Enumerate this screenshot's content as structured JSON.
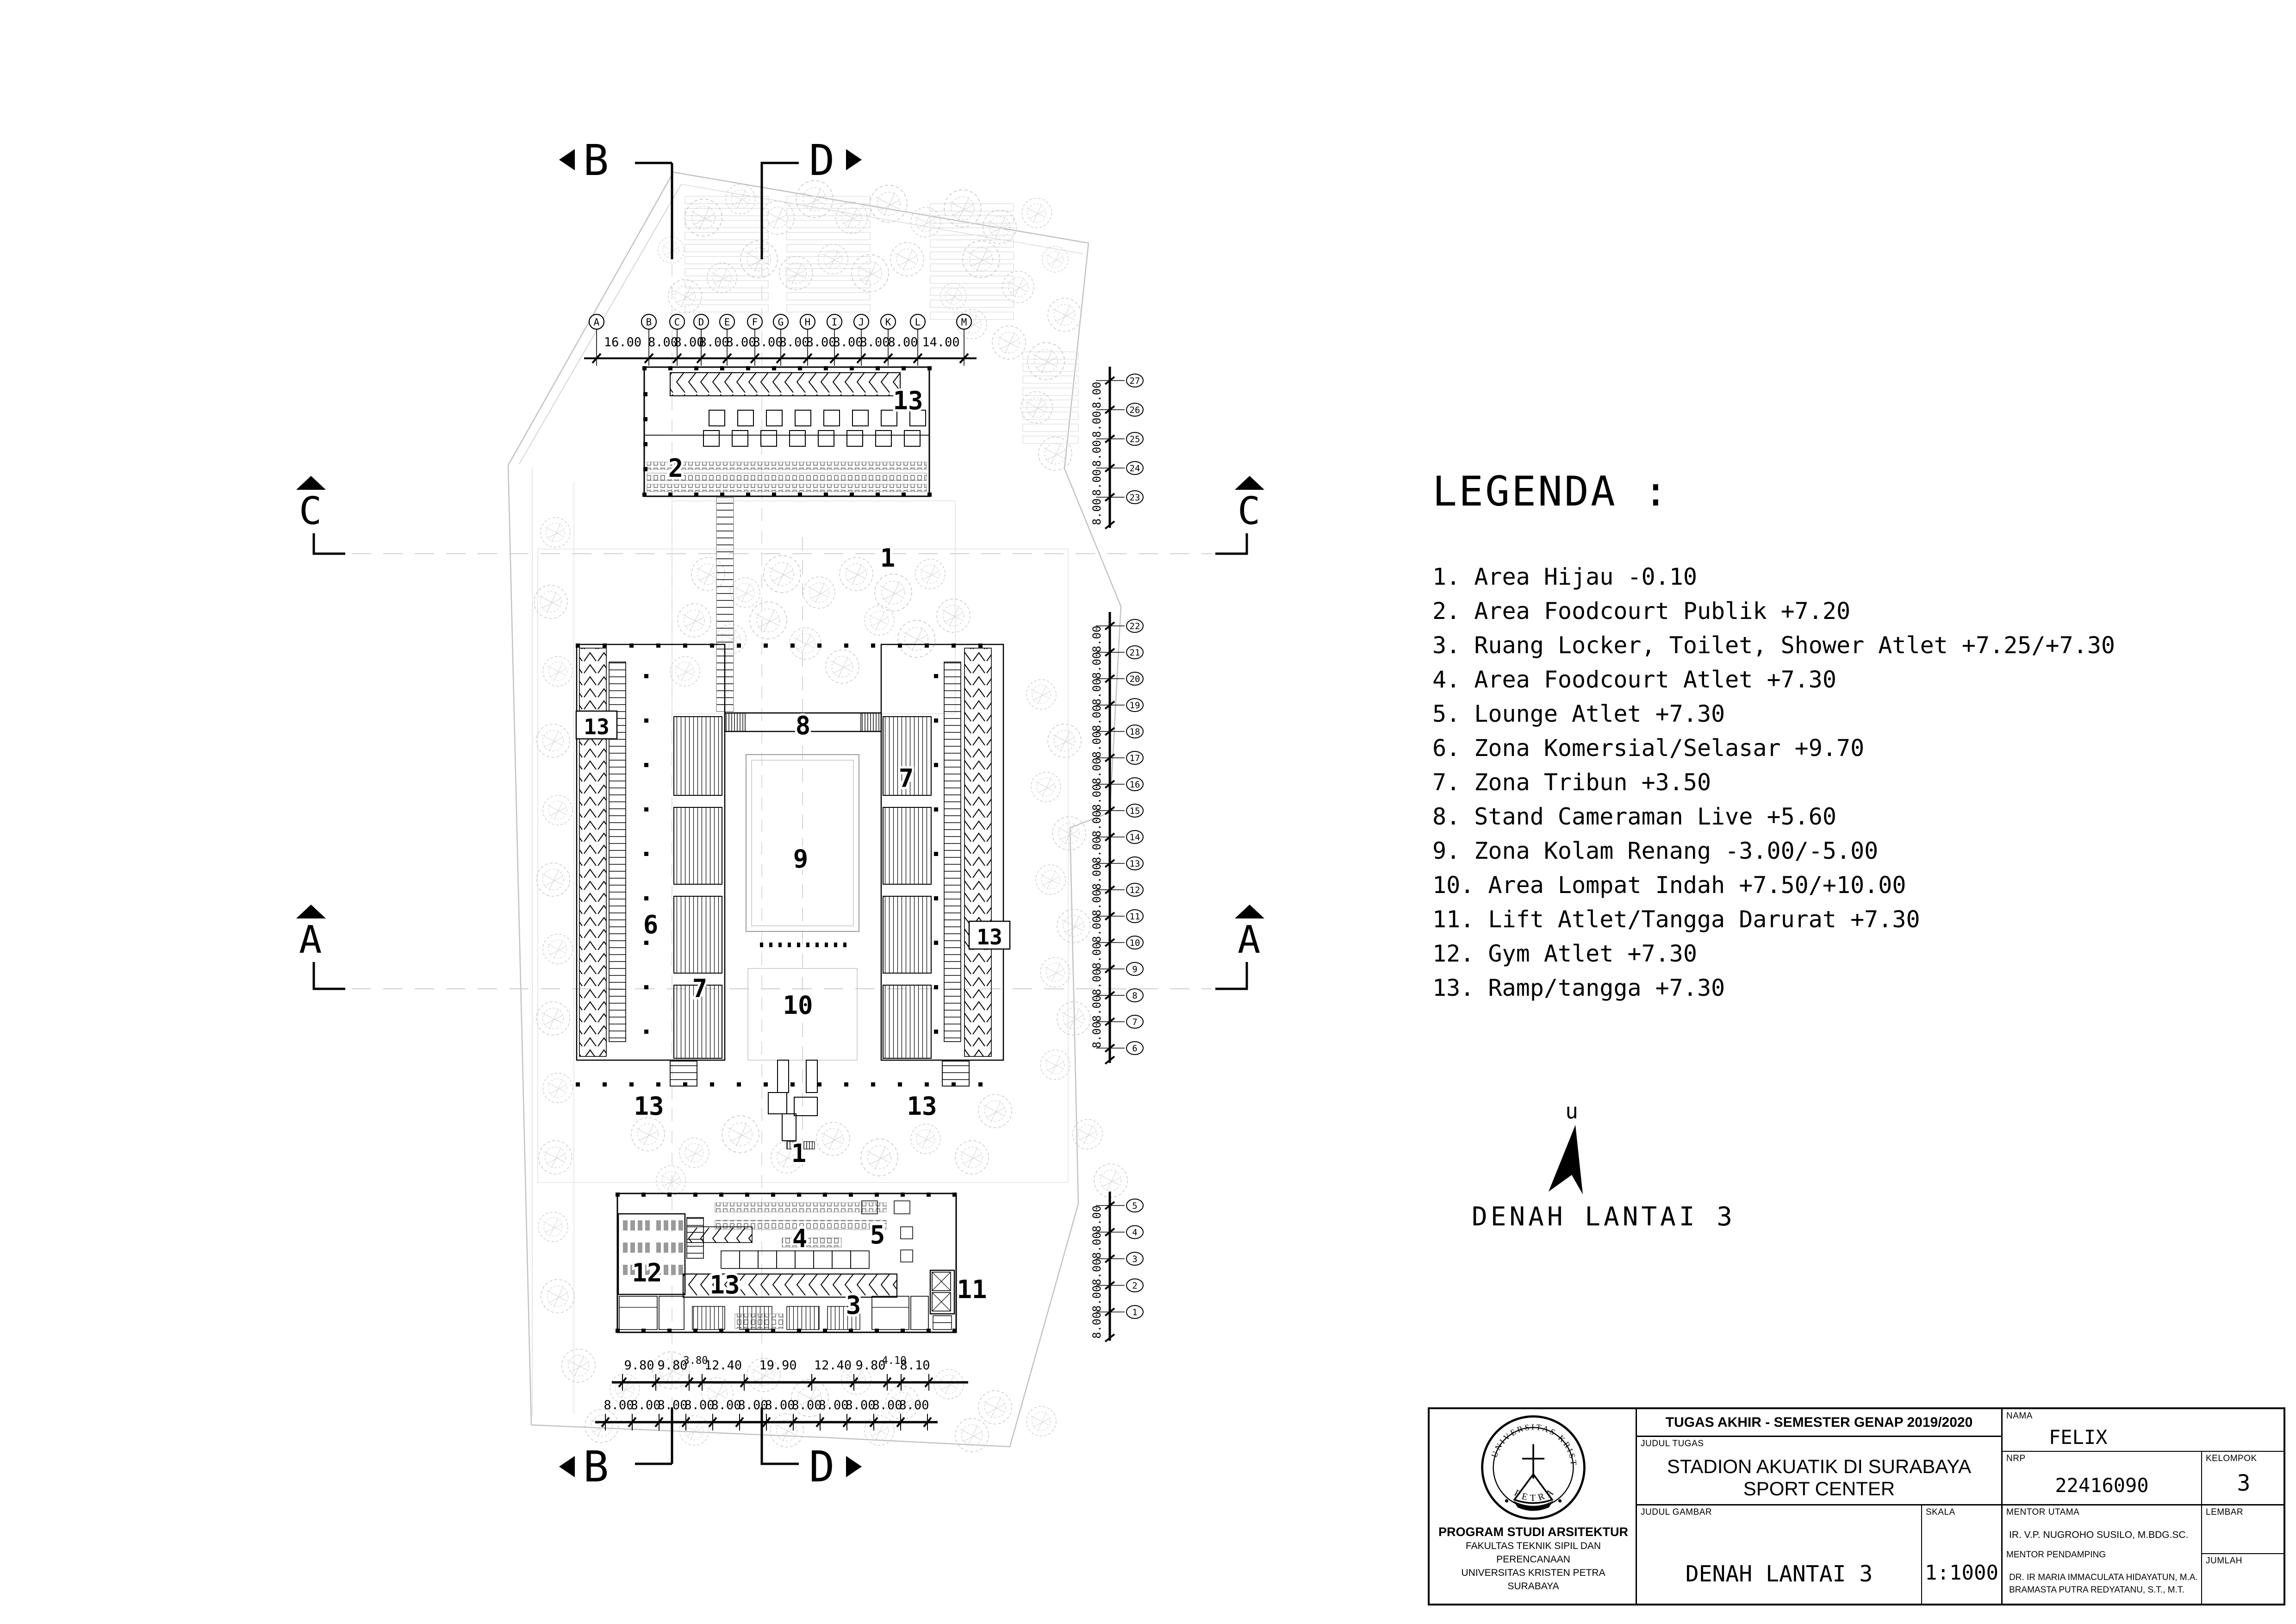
{
  "legend": {
    "title": "LEGENDA :",
    "items": [
      "1. Area Hijau -0.10",
      "2. Area Foodcourt Publik +7.20",
      "3. Ruang Locker, Toilet, Shower Atlet +7.25/+7.30",
      "4. Area Foodcourt Atlet +7.30",
      "5. Lounge Atlet +7.30",
      "6. Zona Komersial/Selasar +9.70",
      "7. Zona Tribun +3.50",
      "8. Stand Cameraman Live +5.60",
      "9. Zona Kolam Renang -3.00/-5.00",
      "10. Area Lompat Indah +7.50/+10.00",
      "11. Lift Atlet/Tangga Darurat +7.30",
      "12. Gym Atlet +7.30",
      "13. Ramp/tangga +7.30"
    ]
  },
  "caption": "DENAH LANTAI 3",
  "north": {
    "label": "u"
  },
  "sections": {
    "b": "B",
    "d": "D",
    "c": "C",
    "a": "A"
  },
  "plan": {
    "labels": [
      "13",
      "2",
      "1",
      "13",
      "8",
      "7",
      "9",
      "6",
      "13",
      "7",
      "10",
      "13",
      "13",
      "1",
      "4",
      "5",
      "12",
      "13",
      "11",
      "3"
    ]
  },
  "grid": {
    "top_letters": [
      "A",
      "B",
      "C",
      "D",
      "E",
      "F",
      "G",
      "H",
      "I",
      "J",
      "K",
      "L",
      "M"
    ],
    "top_dims": [
      "16.00",
      "8.00",
      "8.00",
      "8.00",
      "8.00",
      "8.00",
      "8.00",
      "8.00",
      "8.00",
      "8.00",
      "8.00",
      "14.00"
    ],
    "bottom_dims_upper": [
      "9.80",
      "9.80",
      "3.80",
      "12.40",
      "19.90",
      "12.40",
      "9.80",
      "4.10",
      "8.10"
    ],
    "bottom_dims_lower": [
      "8.00",
      "8.00",
      "8.00",
      "8.00",
      "8.00",
      "8.00",
      "8.00",
      "8.00",
      "8.00",
      "8.00",
      "8.00",
      "8.00"
    ],
    "right_dim_label": "8.00",
    "right_chain_top": [
      "27",
      "26",
      "25",
      "24",
      "23"
    ],
    "right_chain_mid": [
      "22",
      "21",
      "20",
      "19",
      "18",
      "17",
      "16",
      "15",
      "14",
      "13",
      "12",
      "11",
      "10",
      "9",
      "8",
      "7",
      "6"
    ],
    "right_chain_bottom": [
      "5",
      "4",
      "3",
      "2",
      "1"
    ]
  },
  "title_block": {
    "header": "TUGAS AKHIR - SEMESTER GENAP 2019/2020",
    "judul_tugas_label": "JUDUL TUGAS",
    "judul_tugas_1": "STADION AKUATIK DI SURABAYA",
    "judul_tugas_2": "SPORT CENTER",
    "judul_gambar_label": "JUDUL GAMBAR",
    "judul_gambar": "DENAH LANTAI 3",
    "skala_label": "SKALA",
    "skala": "1:1000",
    "nama_label": "NAMA",
    "nama": "FELIX",
    "nrp_label": "NRP",
    "nrp": "22416090",
    "kelompok_label": "KELOMPOK",
    "kelompok": "3",
    "mentor_utama_label": "MENTOR UTAMA",
    "mentor_utama": "IR. V.P. NUGROHO SUSILO, M.BDG.SC.",
    "mentor_pendamping_label": "MENTOR PENDAMPING",
    "mentor_pendamping_1": "DR. IR MARIA IMMACULATA HIDAYATUN, M.A.",
    "mentor_pendamping_2": "BRAMASTA PUTRA REDYATANU, S.T., M.T.",
    "lembar_label": "LEMBAR",
    "jumlah_label": "JUMLAH",
    "inst_1": "PROGRAM STUDI ARSITEKTUR",
    "inst_2": "FAKULTAS TEKNIK SIPIL DAN PERENCANAAN",
    "inst_3": "UNIVERSITAS KRISTEN PETRA",
    "inst_4": "SURABAYA",
    "logo_top": "UNIVERSITAS KRISTEN",
    "logo_bottom": "PETRA"
  }
}
